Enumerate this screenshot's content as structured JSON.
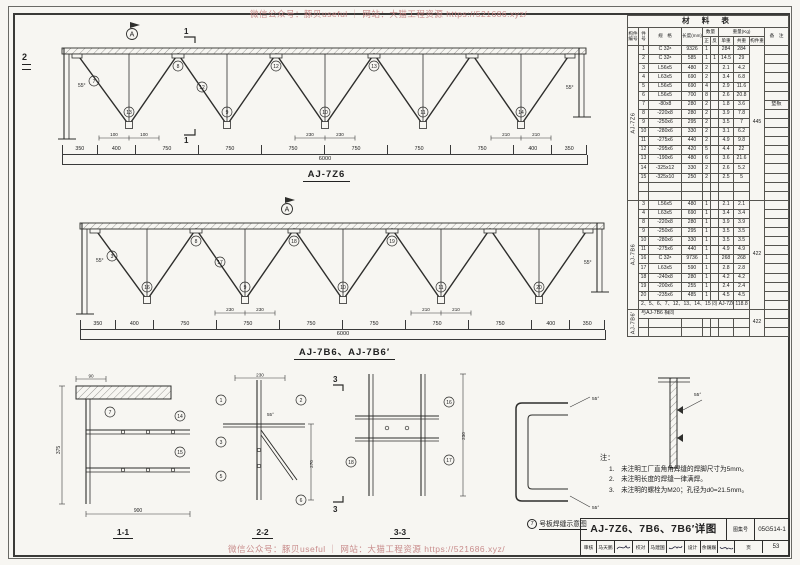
{
  "watermark": {
    "text": "微信公众号：豚贝useful ｜ 网站：大猫工程资源 https://521686.xyz/"
  },
  "misc": {
    "marker_a": "A",
    "cut1": "1",
    "cut2": "2",
    "cut3": "3",
    "angle": "55°"
  },
  "truss1": {
    "label": "AJ-7Z6",
    "dims_segments": [
      "350",
      "400",
      "750",
      "750",
      "750",
      "750",
      "750",
      "750",
      "400",
      "350"
    ],
    "dims_total": "6000",
    "small_dims": [
      "100",
      "100",
      "230",
      "230",
      "210",
      "210"
    ],
    "bubbles": [
      "7",
      "13",
      "8",
      "12",
      "9",
      "12",
      "10",
      "13",
      "11",
      "14"
    ]
  },
  "truss2": {
    "label": "AJ-7B6、AJ-7B6′",
    "dims_segments": [
      "350",
      "400",
      "750",
      "750",
      "750",
      "750",
      "750",
      "750",
      "400",
      "350"
    ],
    "dims_total": "6000",
    "small_dims": [
      "230",
      "230",
      "210",
      "210"
    ],
    "bubbles": [
      "3",
      "16",
      "8",
      "17",
      "9",
      "18",
      "10",
      "19",
      "11",
      "20"
    ]
  },
  "sections": {
    "s11": {
      "label": "1-1",
      "dim_left": "375",
      "dim_bottom": "900",
      "dim_top": "90",
      "bubbles": [
        "7",
        "14",
        "15"
      ]
    },
    "s22": {
      "label": "2-2",
      "dim_top": "230",
      "dim_right": "270",
      "bubbles": [
        "1",
        "3",
        "5",
        "2",
        "6"
      ]
    },
    "s33": {
      "label": "3-3",
      "dim_right": "230",
      "bubbles": [
        "16",
        "17",
        "18"
      ]
    },
    "weld": {
      "bubble": "7",
      "label": "号板焊缝示意图"
    }
  },
  "notes": {
    "title": "注：",
    "items": [
      "1.　未注明工厂直角角焊缝的焊脚尺寸为5mm。",
      "2.　未注明长度的焊缝一律满焊。",
      "3.　未注明的螺栓为M20；孔径为d0=21.5mm。"
    ]
  },
  "table": {
    "cols": [
      11,
      10,
      33,
      21,
      8,
      8,
      15,
      16,
      15,
      24
    ],
    "rows": [
      [
        {
          "t": "材  料  表",
          "c": 10,
          "b": 1
        }
      ],
      [
        {
          "t": "构件编号",
          "r": 2,
          "h": 1
        },
        {
          "t": "件号",
          "r": 2,
          "h": 1
        },
        {
          "t": "规　格",
          "r": 2,
          "h": 1
        },
        {
          "t": "长度(mm)",
          "r": 2,
          "h": 1
        },
        {
          "t": "数量",
          "c": 2,
          "h": 1
        },
        {
          "t": "重量(Kg)",
          "c": 3,
          "h": 1
        },
        {
          "t": "备　注",
          "r": 2,
          "h": 1
        }
      ],
      [
        {
          "t": "正",
          "h": 1
        },
        {
          "t": "反",
          "h": 1
        },
        {
          "t": "单重",
          "h": 1
        },
        {
          "t": "共重",
          "h": 1
        },
        {
          "t": "构件重",
          "h": 1
        }
      ],
      [
        {
          "t": "AJ-7Z6",
          "r": 17,
          "v": 1
        },
        "1",
        "C 32ᵃ",
        "9326",
        "1",
        "",
        "284",
        "284",
        {
          "t": "445",
          "r": 17
        },
        ""
      ],
      [
        "2",
        "C 32ᵃ",
        "585",
        "1",
        "1",
        "14.5",
        "29",
        ""
      ],
      [
        "3",
        "L56x5",
        "480",
        "2",
        "",
        "2.1",
        "4.2",
        ""
      ],
      [
        "4",
        "L63x5",
        "690",
        "2",
        "",
        "3.4",
        "6.8",
        ""
      ],
      [
        "5",
        "L56x5",
        "690",
        "4",
        "",
        "2.9",
        "11.6",
        ""
      ],
      [
        "6",
        "L56x5",
        "700",
        "8",
        "",
        "2.6",
        "20.8",
        ""
      ],
      [
        "7",
        "-80x8",
        "280",
        "2",
        "",
        "1.8",
        "3.6",
        "垫板"
      ],
      [
        "8",
        "-220x8",
        "280",
        "2",
        "",
        "3.9",
        "7.8",
        ""
      ],
      [
        "9",
        "-250x6",
        "295",
        "2",
        "",
        "3.5",
        "7",
        ""
      ],
      [
        "10",
        "-280x6",
        "330",
        "2",
        "",
        "3.1",
        "6.2",
        ""
      ],
      [
        "11",
        "-275x6",
        "440",
        "2",
        "",
        "4.9",
        "9.8",
        ""
      ],
      [
        "12",
        "-295x6",
        "420",
        "5",
        "",
        "4.4",
        "22",
        ""
      ],
      [
        "13",
        "-190x6",
        "480",
        "6",
        "",
        "3.6",
        "21.6",
        ""
      ],
      [
        "14",
        "-325x12",
        "330",
        "2",
        "",
        "2.6",
        "5.2",
        ""
      ],
      [
        "15",
        "-325x10",
        "250",
        "2",
        "",
        "2.5",
        "5",
        ""
      ],
      [
        "",
        "",
        "",
        "",
        "",
        "",
        "",
        ""
      ],
      [
        "",
        "",
        "",
        "",
        "",
        "",
        "",
        ""
      ],
      [
        {
          "t": "AJ-7B6",
          "r": 12,
          "v": 1
        },
        "3",
        "L56x5",
        "480",
        "1",
        "",
        "2.1",
        "2.1",
        {
          "t": "422",
          "r": 12
        },
        ""
      ],
      [
        "4",
        "L63x5",
        "690",
        "1",
        "",
        "3.4",
        "3.4",
        ""
      ],
      [
        "8",
        "-220x8",
        "280",
        "1",
        "",
        "3.9",
        "3.9",
        ""
      ],
      [
        "9",
        "-250x6",
        "295",
        "1",
        "",
        "3.5",
        "3.5",
        ""
      ],
      [
        "10",
        "-280x6",
        "330",
        "1",
        "",
        "3.5",
        "3.5",
        ""
      ],
      [
        "11",
        "-275x6",
        "440",
        "1",
        "",
        "4.9",
        "4.9",
        ""
      ],
      [
        "16",
        "C 32ᵃ",
        "9736",
        "1",
        "",
        "268",
        "268",
        ""
      ],
      [
        "17",
        "L63x5",
        "590",
        "1",
        "",
        "2.8",
        "2.8",
        ""
      ],
      [
        "18",
        "-240x8",
        "280",
        "1",
        "",
        "4.2",
        "4.2",
        ""
      ],
      [
        "19",
        "-200x6",
        "255",
        "1",
        "",
        "2.4",
        "2.4",
        ""
      ],
      [
        "20",
        "-235x6",
        "485",
        "1",
        "",
        "4.5",
        "4.5",
        ""
      ],
      [
        {
          "t": "2、5、6、7、12、13、14、15 同 AJ-7Z6",
          "c": 6,
          "a": 1
        },
        "118.8",
        ""
      ],
      [
        {
          "t": "AJ-7B6′",
          "r": 3,
          "v": 1
        },
        {
          "t": "与AJ-7B6 相同",
          "c": 7,
          "a": 1
        },
        {
          "t": "422",
          "r": 3
        },
        ""
      ],
      [
        "",
        "",
        "",
        "",
        "",
        "",
        "",
        ""
      ],
      [
        "",
        "",
        "",
        "",
        "",
        "",
        "",
        ""
      ]
    ]
  },
  "title_block": {
    "title": "AJ-7Z6、7B6、7B6′详图",
    "atlas_label": "图集号",
    "atlas_no": "05G514-1",
    "review_label": "审核",
    "review_name": "马天鹏",
    "proof_label": "校对",
    "proof_name": "马建国",
    "design_label": "设计",
    "design_name": "余巍巍",
    "page_label": "页",
    "page_no": "53"
  }
}
